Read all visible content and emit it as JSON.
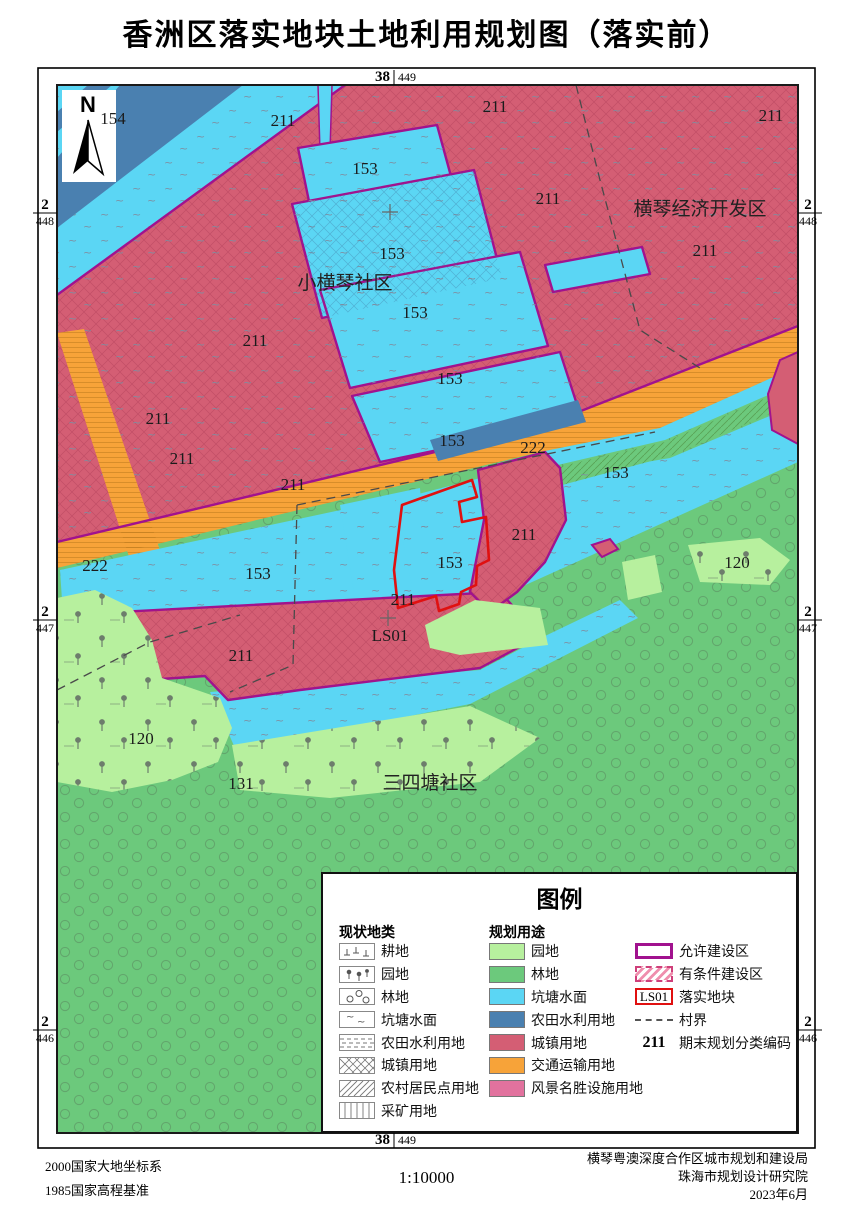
{
  "title": "香洲区落实地块土地利用规划图（落实前）",
  "colors": {
    "orchard": "#b7f09e",
    "forest": "#6cc97c",
    "pond": "#5bd6f4",
    "farm_water": "#4a80b0",
    "urban": "#d45e74",
    "transport": "#f7a339",
    "scenic": "#e2729e",
    "allowed_border": "#a1128e",
    "plot_border": "#e01010"
  },
  "north_label": "N",
  "grid": {
    "top": {
      "main": "38",
      "sub": "449"
    },
    "bottom": {
      "main": "38",
      "sub": "449"
    },
    "left": [
      {
        "main": "2",
        "sub": "448"
      },
      {
        "main": "2",
        "sub": "447"
      },
      {
        "main": "2",
        "sub": "446"
      }
    ],
    "right": [
      {
        "main": "2",
        "sub": "448"
      },
      {
        "main": "2",
        "sub": "447"
      },
      {
        "main": "2",
        "sub": "446"
      }
    ]
  },
  "map": {
    "labels": [
      {
        "t": "154",
        "x": 113,
        "y": 124,
        "cls": "c"
      },
      {
        "t": "211",
        "x": 283,
        "y": 126,
        "cls": "c"
      },
      {
        "t": "211",
        "x": 495,
        "y": 112,
        "cls": "c"
      },
      {
        "t": "211",
        "x": 771,
        "y": 121,
        "cls": "c"
      },
      {
        "t": "211",
        "x": 548,
        "y": 204,
        "cls": "c"
      },
      {
        "t": "211",
        "x": 705,
        "y": 256,
        "cls": "c"
      },
      {
        "t": "211",
        "x": 255,
        "y": 346,
        "cls": "c"
      },
      {
        "t": "211",
        "x": 158,
        "y": 424,
        "cls": "c"
      },
      {
        "t": "211",
        "x": 182,
        "y": 464,
        "cls": "c"
      },
      {
        "t": "211",
        "x": 293,
        "y": 490,
        "cls": "c"
      },
      {
        "t": "211",
        "x": 524,
        "y": 540,
        "cls": "c"
      },
      {
        "t": "211",
        "x": 403,
        "y": 605,
        "cls": "c"
      },
      {
        "t": "211",
        "x": 241,
        "y": 661,
        "cls": "c"
      },
      {
        "t": "153",
        "x": 365,
        "y": 174,
        "cls": "c"
      },
      {
        "t": "153",
        "x": 392,
        "y": 259,
        "cls": "c"
      },
      {
        "t": "153",
        "x": 415,
        "y": 318,
        "cls": "c"
      },
      {
        "t": "153",
        "x": 450,
        "y": 384,
        "cls": "c"
      },
      {
        "t": "153",
        "x": 452,
        "y": 446,
        "cls": "c"
      },
      {
        "t": "153",
        "x": 616,
        "y": 478,
        "cls": "c"
      },
      {
        "t": "153",
        "x": 258,
        "y": 579,
        "cls": "c"
      },
      {
        "t": "153",
        "x": 450,
        "y": 568,
        "cls": "c"
      },
      {
        "t": "222",
        "x": 95,
        "y": 571,
        "cls": "c"
      },
      {
        "t": "222",
        "x": 533,
        "y": 453,
        "cls": "c"
      },
      {
        "t": "120",
        "x": 141,
        "y": 744,
        "cls": "c"
      },
      {
        "t": "120",
        "x": 737,
        "y": 568,
        "cls": "c"
      },
      {
        "t": "131",
        "x": 241,
        "y": 789,
        "cls": "c"
      },
      {
        "t": "LS01",
        "x": 390,
        "y": 641,
        "cls": "c"
      },
      {
        "t": "小横琴社区",
        "x": 345,
        "y": 289,
        "cls": "n"
      },
      {
        "t": "横琴经济开发区",
        "x": 700,
        "y": 215,
        "cls": "n"
      },
      {
        "t": "三四塘社区",
        "x": 430,
        "y": 789,
        "cls": "n"
      }
    ]
  },
  "legend": {
    "title": "图例",
    "current": {
      "header": "现状地类",
      "items": [
        {
          "label": "耕地"
        },
        {
          "label": "园地"
        },
        {
          "label": "林地"
        },
        {
          "label": "坑塘水面"
        },
        {
          "label": "农田水利用地"
        },
        {
          "label": "城镇用地"
        },
        {
          "label": "农村居民点用地"
        },
        {
          "label": "采矿用地"
        }
      ]
    },
    "planned": {
      "header": "规划用途",
      "items": [
        {
          "label": "园地",
          "color": "#b7f09e"
        },
        {
          "label": "林地",
          "color": "#6cc97c"
        },
        {
          "label": "坑塘水面",
          "color": "#5bd6f4"
        },
        {
          "label": "农田水利用地",
          "color": "#4a80b0"
        },
        {
          "label": "城镇用地",
          "color": "#d45e74"
        },
        {
          "label": "交通运输用地",
          "color": "#f7a339"
        },
        {
          "label": "风景名胜设施用地",
          "color": "#e2729e"
        }
      ]
    },
    "other": {
      "allowed": "允许建设区",
      "conditional": "有条件建设区",
      "plot_code": "LS01",
      "plot": "落实地块",
      "village": "村界",
      "code_sample": "211",
      "code_label": "期末规划分类编码"
    }
  },
  "footer": {
    "datum1": "2000国家大地坐标系",
    "datum2": "1985国家高程基准",
    "scale": "1:10000",
    "org1": "横琴粤澳深度合作区城市规划和建设局",
    "org2": "珠海市规划设计研究院",
    "date": "2023年6月"
  }
}
